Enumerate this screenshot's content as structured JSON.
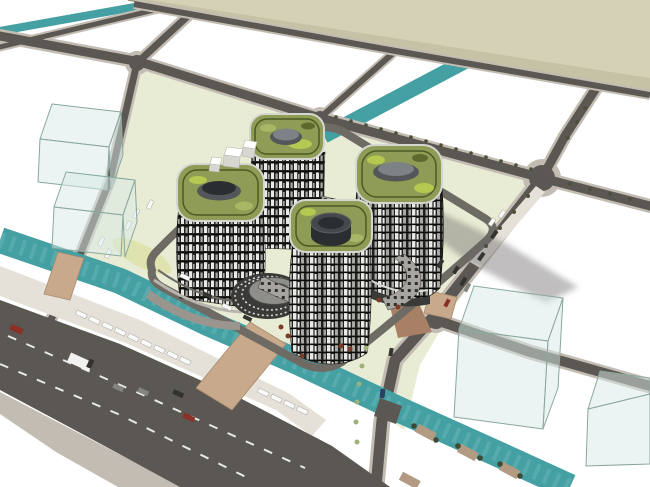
{
  "meta": {
    "render_type": "aerial-axonometric-architectural-massing-render",
    "style": "sketchup-like",
    "description": "Bird's-eye render of a four-tower complex with green roofs and striped facades on a pale site, surrounded by white parcels, grey roads, teal canals, a wide boulevard with traffic, translucent massing boxes and a large beige parcel at top"
  },
  "colors": {
    "background": "#ffffff",
    "beige_plane": "#d5d1b6",
    "beige_band": "#c6c2a6",
    "beige_edge": "#97927a",
    "road_asphalt": "#5b5752",
    "road_sidewalk": "#c2bcb2",
    "dock": "#e5e1d9",
    "canal": "#44a0a2",
    "canal_light": "#6fb9ba",
    "site_ground": "#e9ecd4",
    "site_median": "#dfe3b0",
    "ring_road": "#6e6a64",
    "lane_marking": "#e8e8e4",
    "shadow": "rgba(105,103,100,0.42)",
    "tan_bridge": "#c8a98c",
    "canopy": "#a88066",
    "glass_fill": "rgba(216,234,229,0.5)",
    "glass_edge": "#8aa79d",
    "facade_dark": "#20201e",
    "facade_light": "#e9e9e6",
    "facade_mid": "#a9a9a4",
    "facade_floor": "#0c0c0b",
    "roof_green": "#8e9c55",
    "roof_rim": "#d6d6d1",
    "roof_ring": "#4c5a24",
    "roof_patch_lime": "#b5c84f",
    "roof_patch_dark": "#5c6b2d",
    "roof_patch_mid": "#a6b765",
    "drum_side": "#53575a",
    "drum_top": "#7d8286",
    "cylinder_dark": "#2b2e30",
    "cylinder_top": "#44484a",
    "bridge_band": "#a8a5a0",
    "bridge_window": "#2e2e2c",
    "podium_gray": "#9a968f",
    "podium_line": "#b8b5af",
    "ellipse_dark": "#3a3a38",
    "ellipse_top": "#8e8e8a",
    "ellipse_tick": "#d8d8d4",
    "car_white": "#fafafa",
    "car_red": "#8c2f25",
    "car_gray": "#84847f",
    "car_dark": "#33332f",
    "car_blue": "#2a3f66",
    "truck_white": "#f2f2f0",
    "tree_olive": "#4a4f38",
    "tree_dark": "#3f4a35",
    "shrub_green": "#9db27a",
    "planter_red": "#7a3b28",
    "pontoon_tan": "#b39a82",
    "white_box_top": "#ffffff",
    "white_box_side": "#d8d6d0"
  },
  "scene": {
    "site": {
      "shape": "rounded-diamond parcel",
      "ground": "pale yellow-green",
      "ring_road": true
    },
    "towers": [
      {
        "id": "tower-north",
        "roof": "green with grey drum",
        "facade": "black-white striped"
      },
      {
        "id": "tower-west",
        "roof": "green with grey drum",
        "facade": "black-white striped"
      },
      {
        "id": "tower-east",
        "roof": "green with grey drum",
        "facade": "black-white striped"
      },
      {
        "id": "tower-south",
        "roof": "green with dark cylinder",
        "facade": "black-white striped"
      }
    ],
    "central_building": "stepped elliptical podium",
    "sky_bridges": 4,
    "water": {
      "canals": 3,
      "color_name": "teal"
    },
    "crossings": {
      "tan_bridges": 2,
      "pontoons": 4
    },
    "surroundings": {
      "glass_boxes": 4,
      "white_boxes": 3,
      "parcels": "white with grey road grid",
      "beige_parcel": "large flat plane at top"
    },
    "vehicles": {
      "boulevard": 7,
      "parked_white": 22,
      "internal_dark": 12,
      "trees_rows": 5
    }
  }
}
